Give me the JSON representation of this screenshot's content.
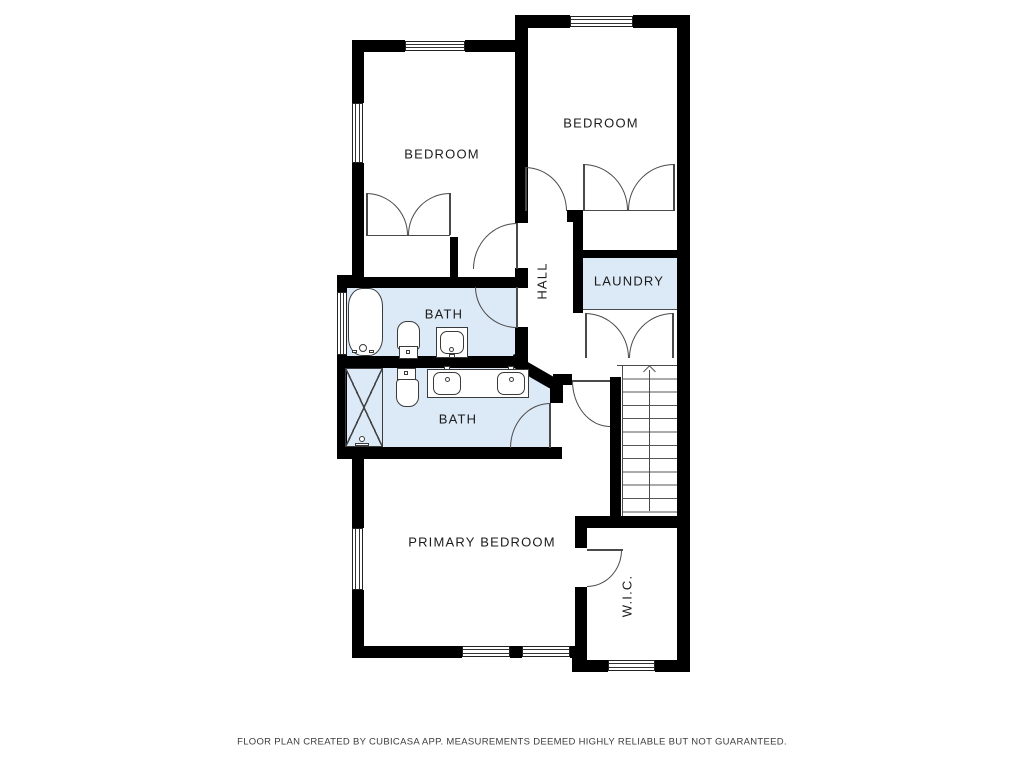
{
  "document": {
    "type": "floor-plan",
    "creator_note": "FLOOR PLAN CREATED BY CUBICASA APP. MEASUREMENTS DEEMED HIGHLY RELIABLE BUT NOT GUARANTEED."
  },
  "rooms": [
    {
      "name": "bedroom-1",
      "label": "BEDROOM"
    },
    {
      "name": "bedroom-2",
      "label": "BEDROOM"
    },
    {
      "name": "bath-1",
      "label": "BATH"
    },
    {
      "name": "bath-2",
      "label": "BATH"
    },
    {
      "name": "hall",
      "label": "HALL",
      "label_rotated": true
    },
    {
      "name": "laundry",
      "label": "LAUNDRY"
    },
    {
      "name": "primary-bedroom",
      "label": "PRIMARY BEDROOM"
    },
    {
      "name": "walk-in-closet",
      "label": "W.I.C.",
      "label_rotated": true
    }
  ],
  "fixtures": [
    "bathtub",
    "toilet",
    "vanity-sink",
    "shower",
    "shower-head",
    "toilet",
    "double-vanity-sink"
  ],
  "stairs": {
    "direction": "up",
    "treads": 11
  },
  "doors": {
    "hinged": 6,
    "bifold_double": 3
  },
  "windows_count": 8,
  "colors": {
    "wall": "#000000",
    "wet_room_fill": "#dce9f7",
    "line": "#4a4a4a",
    "label_text": "#1c1c1c"
  }
}
